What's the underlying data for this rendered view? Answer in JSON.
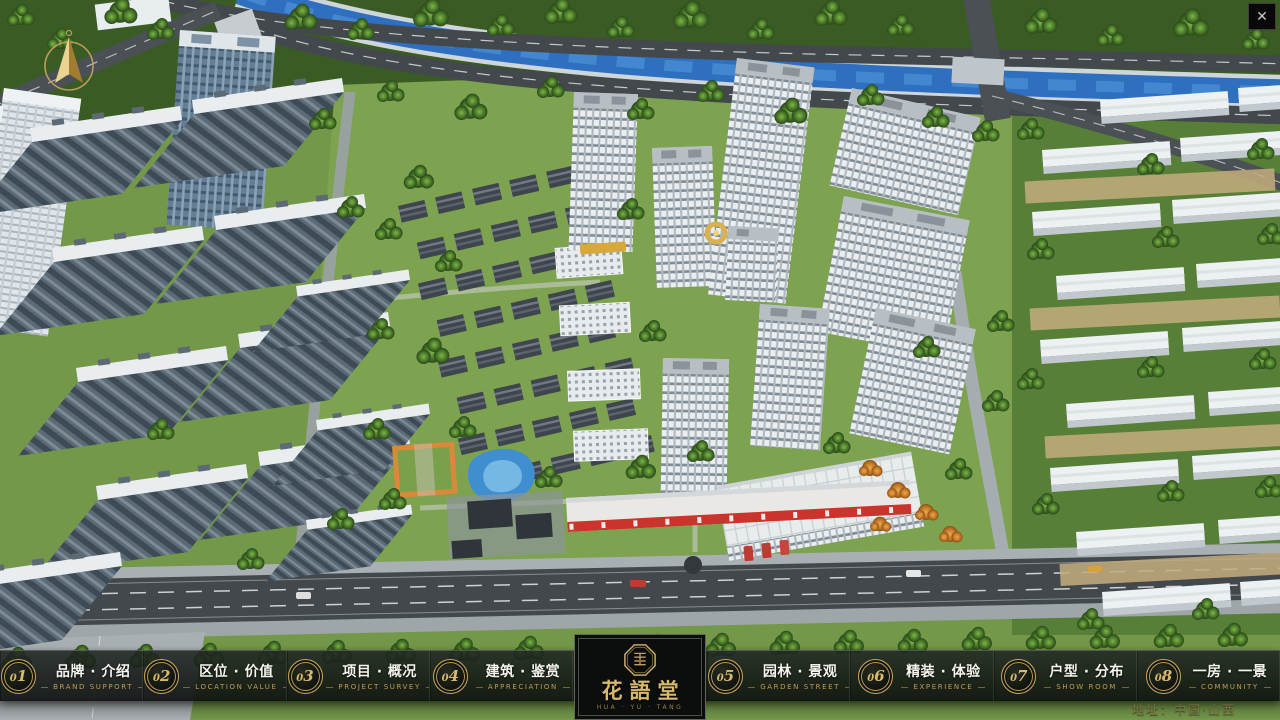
{
  "chrome": {
    "close_glyph": "✕"
  },
  "nav": {
    "items": [
      {
        "num": "01",
        "zh": "品牌 · 介绍",
        "en": "BRAND SUPPORT"
      },
      {
        "num": "02",
        "zh": "区位 · 价值",
        "en": "LOCATION VALUE"
      },
      {
        "num": "03",
        "zh": "项目 · 概况",
        "en": "PROJECT SURVEY"
      },
      {
        "num": "04",
        "zh": "建筑 · 鉴赏",
        "en": "APPRECIATION"
      },
      {
        "num": "05",
        "zh": "园林 · 景观",
        "en": "GARDEN STREET"
      },
      {
        "num": "06",
        "zh": "精装 · 体验",
        "en": "EXPERIENCE"
      },
      {
        "num": "07",
        "zh": "户型 · 分布",
        "en": "SHOW ROOM"
      },
      {
        "num": "08",
        "zh": "一房 · 一景",
        "en": "COMMUNITY"
      }
    ]
  },
  "logo": {
    "title": "花語堂",
    "subtitle": "HUA · YU · TANG"
  },
  "footer": {
    "address": "地址：中国·山西"
  },
  "colors": {
    "gold": "#c9a962",
    "bar_bg": "#10米141290",
    "water": "#2e6fc0",
    "asphalt": "#43484c"
  }
}
